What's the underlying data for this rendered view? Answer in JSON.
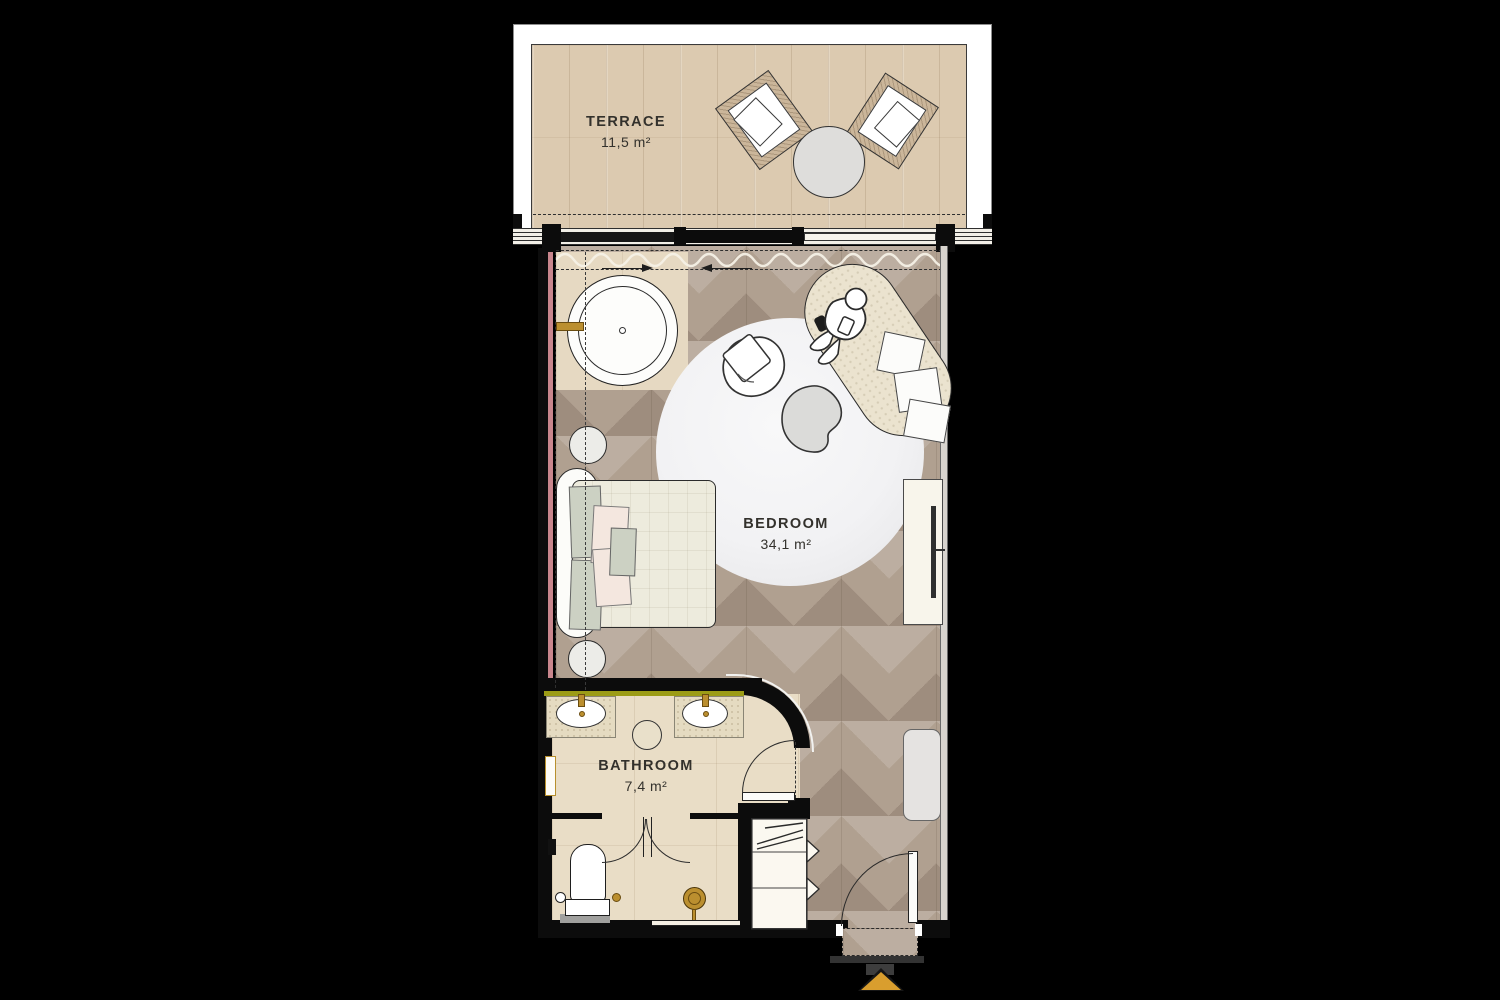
{
  "meta": {
    "type": "hotel-suite-floor-plan"
  },
  "rooms": {
    "terrace": {
      "label": "TERRACE",
      "area": "11,5 m²"
    },
    "bedroom": {
      "label": "BEDROOM",
      "area": "34,1 m²"
    },
    "bathroom": {
      "label": "BATHROOM",
      "area": "7,4 m²"
    }
  },
  "icons": {
    "entry_marker": "entry-arrow-triangle"
  },
  "colors": {
    "background": "#000000",
    "wood_floor": "#b0a090",
    "terrace_tile": "#dccab0",
    "bathroom_tile": "#e9ddc6",
    "wall": "#0c0c0c",
    "counter_accent_olive": "#9c9c16",
    "brass_fixture": "#bb8f2f",
    "entry_arrow_amber": "#d99e2e",
    "wall_accent_pink": "#c9868d",
    "rug": "#f1f1f3",
    "label_text": "#33312c"
  }
}
